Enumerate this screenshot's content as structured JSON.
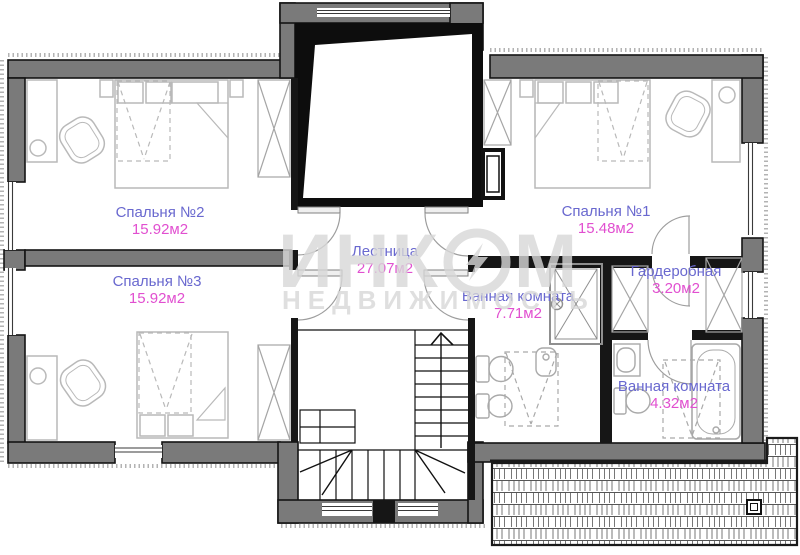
{
  "plan_title": "second-floor-plan",
  "rooms": [
    {
      "name": "Спальня №2",
      "area": "15.92м2"
    },
    {
      "name": "Спальня №3",
      "area": "15.92м2"
    },
    {
      "name": "Лестница",
      "area": "27.07м2"
    },
    {
      "name": "Спальня №1",
      "area": "15.48м2"
    },
    {
      "name": "Гардеробная",
      "area": "3.20м2"
    },
    {
      "name": "Ванная комната",
      "area": "7.71м2"
    },
    {
      "name": "Ванная комната",
      "area": "4.32м2"
    }
  ],
  "watermark": {
    "line1_left": "ИНК",
    "line1_right": "М",
    "line2": "НЕДВИЖИМОСТЬ"
  },
  "colors": {
    "room_name": "#6968cf",
    "room_area": "#e14fd0",
    "wall_fill": "#7a7a7a",
    "wall_edge": "#141414",
    "furniture": "#b9b9b9",
    "watermark": "#d8d8d8"
  }
}
